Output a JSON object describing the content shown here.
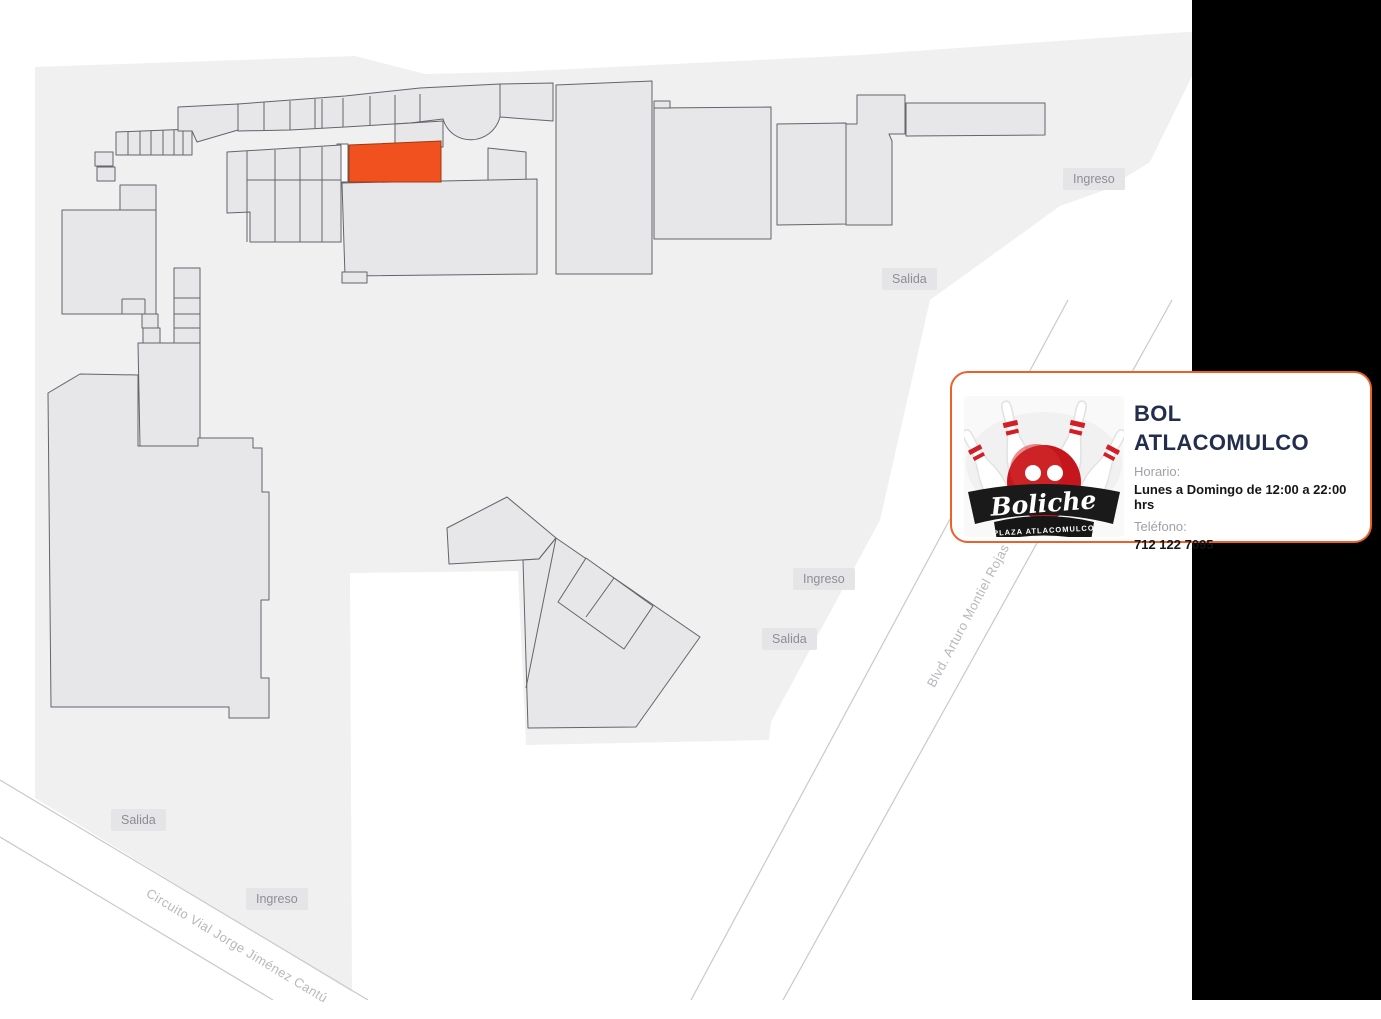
{
  "map": {
    "background_color": "#ffffff",
    "plaza_fill": "#f0f0f1",
    "building_fill": "#e7e7e9",
    "building_stroke": "#64646a",
    "highlight_fill": "#f0511f",
    "side_panel_color": "#000000",
    "chip_bg": "#e5e5e8",
    "chip_text_color": "#8d8d95",
    "markers": [
      {
        "id": "ingreso-top",
        "label": "Ingreso"
      },
      {
        "id": "salida-top",
        "label": "Salida"
      },
      {
        "id": "ingreso-center",
        "label": "Ingreso"
      },
      {
        "id": "salida-center",
        "label": "Salida"
      },
      {
        "id": "salida-bottom",
        "label": "Salida"
      },
      {
        "id": "ingreso-bottom",
        "label": "Ingreso"
      }
    ],
    "streets": [
      {
        "name": "Blvd. Arturo Montiel Rojas"
      },
      {
        "name": "Circuito Vial Jorge Jiménez Cantú"
      }
    ]
  },
  "card": {
    "accent_color": "#ee5f2a",
    "title_line1": "BOL",
    "title_line2": "ATLACOMULCO",
    "hours_label": "Horario:",
    "hours_value": "Lunes a Domingo de 12:00 a 22:00 hrs",
    "phone_label": "Teléfono:",
    "phone_value": "712 122 7095",
    "logo": {
      "script_text": "Boliche",
      "subtext": "PLAZA ATLACOMULCO",
      "ball_color": "#c4161c",
      "ribbon_color": "#1a1a1a"
    }
  }
}
